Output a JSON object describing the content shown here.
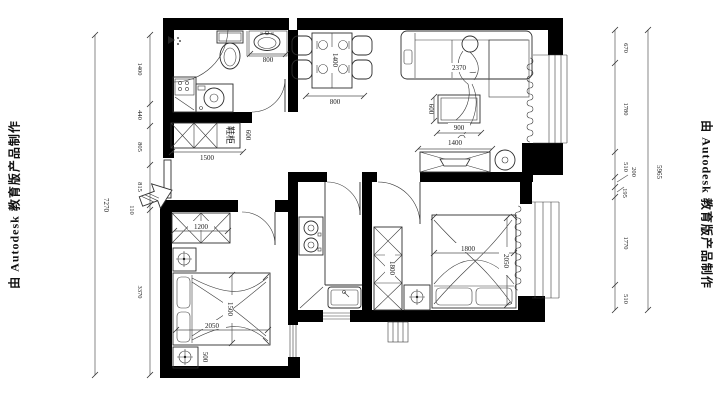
{
  "watermarks": {
    "left": "由 Autodesk 教育版产品制作",
    "right": "由 Autodesk 教育版产品制作"
  },
  "labels": {
    "shoe_cabinet": "鞋柜"
  },
  "dims": {
    "left_total": "7270",
    "left_chain": [
      "1400",
      "440",
      "805",
      "815",
      "110",
      "3370"
    ],
    "right_total": "5965",
    "right_chain": [
      "670",
      "1780",
      "510",
      "200",
      "195",
      "1770",
      "510"
    ],
    "bath_basin": "800",
    "dining_table_width": "800",
    "dining_table_length": "1400",
    "sofa_length": "2370",
    "coffee_table_depth": "600",
    "coffee_table_width": "900",
    "tv_cabinet": "1400",
    "shoe_cabinet_width": "1500",
    "shoe_cabinet_depth": "600",
    "wardrobe_left": "1200",
    "bed_left_width": "1500",
    "bed_left_length": "2050",
    "nightstand_left": "500",
    "wardrobe_right": "1800",
    "bed_right_width": "1800",
    "bed_right_length": "2050"
  },
  "colors": {
    "wall": "#000000",
    "line": "#2e2e2e",
    "background": "#ffffff"
  }
}
